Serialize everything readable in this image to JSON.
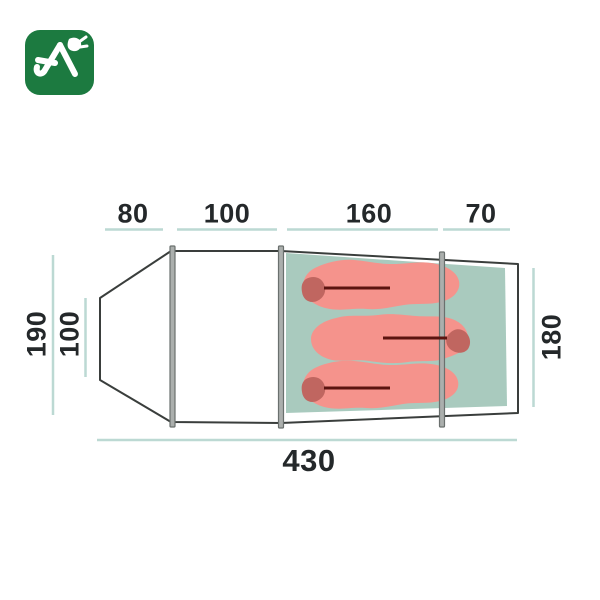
{
  "logo": {
    "bg_color": "#1c7a40",
    "glyph_color": "#ffffff",
    "glyph": "tent-peak-with-pickaxe"
  },
  "palette": {
    "text_color": "#24282a",
    "dimension_line": "#bcd9d3",
    "tent_outline": "#3a3e3c",
    "tent_fill": "#ffffff",
    "groundsheet": "#a9cabe",
    "sleeping_bag": "#f5938c",
    "sleeping_bag_hood": "#c06660",
    "sleeping_bag_zip": "#5c1410",
    "pole_fill": "#abafad",
    "pole_stroke": "#6a706e"
  },
  "dimensions": {
    "top_segments": [
      "80",
      "100",
      "160",
      "70"
    ],
    "total_length": "430",
    "outer_width": "190",
    "porch_inner_width": "100",
    "sleeping_area_width": "180"
  },
  "diagram": {
    "type": "tent-floor-plan-top-view",
    "sleeping_bag_count": 3,
    "pole_count": 3
  }
}
